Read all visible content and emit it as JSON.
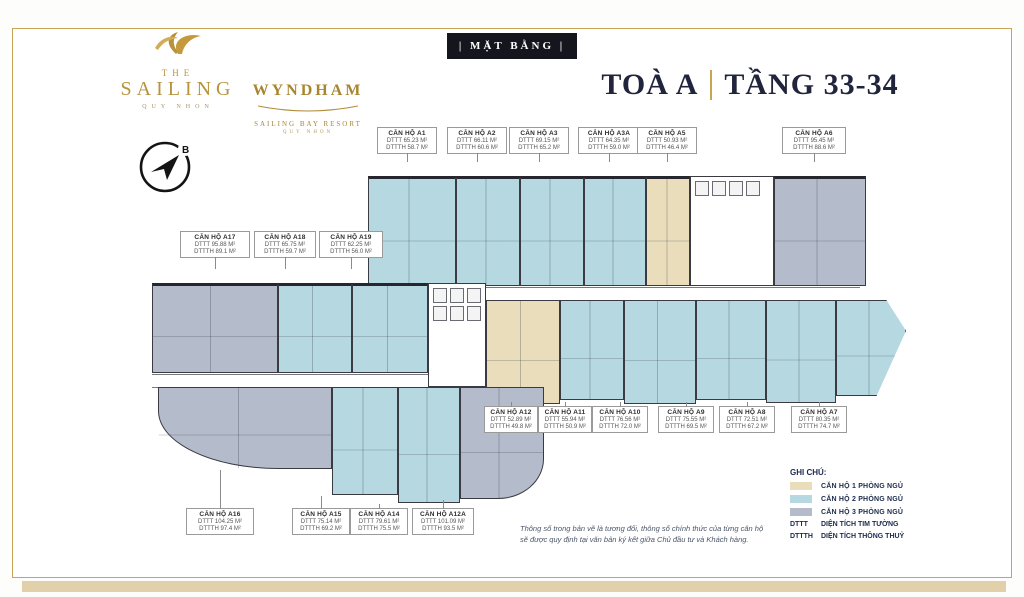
{
  "brand": {
    "sailing": {
      "the": "THE",
      "name": "SAILING",
      "sub": "QUY NHON"
    },
    "wyndham": {
      "name": "WYNDHAM",
      "sub1": "SAILING BAY RESORT",
      "sub2": "QUY NHON"
    },
    "compass_letter": "B"
  },
  "header": {
    "badge": "| MẶT BẰNG |",
    "building": "TOÀ A",
    "floors": "TẦNG 33-34"
  },
  "units": [
    {
      "name": "CĂN HỘ A1",
      "dttt": "DTTT 65.23 M²",
      "dtth": "DTTTH 58.7 M²",
      "type": "2PN"
    },
    {
      "name": "CĂN HỘ A2",
      "dttt": "DTTT 66.11 M²",
      "dtth": "DTTTH 60.6 M²",
      "type": "2PN"
    },
    {
      "name": "CĂN HỘ A3",
      "dttt": "DTTT 69.15 M²",
      "dtth": "DTTTH 65.2 M²",
      "type": "2PN"
    },
    {
      "name": "CĂN HỘ A3A",
      "dttt": "DTTT 64.35 M²",
      "dtth": "DTTTH 59.0 M²",
      "type": "2PN"
    },
    {
      "name": "CĂN HỘ A5",
      "dttt": "DTTT 50.93 M²",
      "dtth": "DTTTH 46.4 M²",
      "type": "1PN"
    },
    {
      "name": "CĂN HỘ A6",
      "dttt": "DTTT 95.45 M²",
      "dtth": "DTTTH 88.6 M²",
      "type": "3PN"
    },
    {
      "name": "CĂN HỘ A17",
      "dttt": "DTTT 95.88 M²",
      "dtth": "DTTTH 89.1 M²",
      "type": "3PN"
    },
    {
      "name": "CĂN HỘ A18",
      "dttt": "DTTT 65.75 M²",
      "dtth": "DTTTH 59.7 M²",
      "type": "2PN"
    },
    {
      "name": "CĂN HỘ A19",
      "dttt": "DTTT 62.25 M²",
      "dtth": "DTTTH 56.0 M²",
      "type": "2PN"
    },
    {
      "name": "CĂN HỘ A12",
      "dttt": "DTTT 52.89 M²",
      "dtth": "DTTTH 49.8 M²",
      "type": "1PN"
    },
    {
      "name": "CĂN HỘ A11",
      "dttt": "DTTT 55.94 M²",
      "dtth": "DTTTH 50.9 M²",
      "type": "2PN"
    },
    {
      "name": "CĂN HỘ A10",
      "dttt": "DTTT 76.56 M²",
      "dtth": "DTTTH 72.0 M²",
      "type": "2PN"
    },
    {
      "name": "CĂN HỘ A9",
      "dttt": "DTTT 75.55 M²",
      "dtth": "DTTTH 69.5 M²",
      "type": "2PN"
    },
    {
      "name": "CĂN HỘ A8",
      "dttt": "DTTT 72.51 M²",
      "dtth": "DTTTH 67.2 M²",
      "type": "2PN"
    },
    {
      "name": "CĂN HỘ A7",
      "dttt": "DTTT 80.35 M²",
      "dtth": "DTTTH 74.7 M²",
      "type": "2PN"
    },
    {
      "name": "CĂN HỘ A16",
      "dttt": "DTTT 104.25 M²",
      "dtth": "DTTTH 97.4 M²",
      "type": "3PN"
    },
    {
      "name": "CĂN HỘ A15",
      "dttt": "DTTT 75.14 M²",
      "dtth": "DTTTH 69.2 M²",
      "type": "2PN"
    },
    {
      "name": "CĂN HỘ A14",
      "dttt": "DTTT 79.61 M²",
      "dtth": "DTTTH 75.5 M²",
      "type": "2PN"
    },
    {
      "name": "CĂN HỘ A12A",
      "dttt": "DTTT 101.09 M²",
      "dtth": "DTTTH 93.5 M²",
      "type": "3PN"
    }
  ],
  "legend": {
    "title": "GHI CHÚ:",
    "items": [
      {
        "label": "CĂN HỘ 1 PHÒNG NGỦ",
        "color": "#e9ddbb"
      },
      {
        "label": "CĂN HỘ 2 PHÒNG NGỦ",
        "color": "#b5d8e1"
      },
      {
        "label": "CĂN HỘ 3 PHÒNG NGỦ",
        "color": "#b4bbca"
      }
    ],
    "abbr": [
      {
        "key": "DTTT",
        "label": "DIỆN TÍCH TIM TƯỜNG"
      },
      {
        "key": "DTTTH",
        "label": "DIỆN TÍCH THÔNG THUỶ"
      }
    ]
  },
  "disclaimer": {
    "line1": "Thông số trong bản vẽ là tương đối, thông số chính thức của từng căn hộ",
    "line2": "sẽ được quy định tại văn bản ký kết giữa Chủ đầu tư và Khách hàng."
  },
  "colors": {
    "gold": "#c9a455",
    "navy": "#1c2b4d",
    "one_br": "#e9ddbb",
    "two_br": "#b5d8e1",
    "three_br": "#b4bbca"
  }
}
